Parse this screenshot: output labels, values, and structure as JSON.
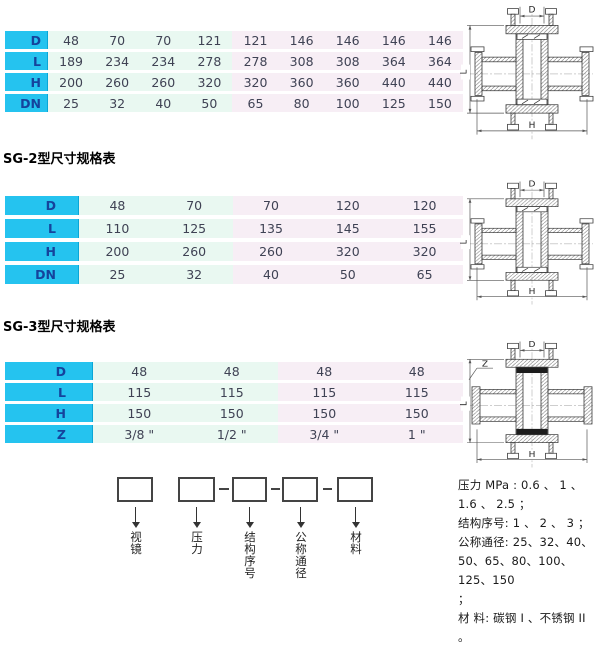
{
  "colors": {
    "header_cyan": "#25c3ef",
    "header_text": "#15439c",
    "mint_bg": "#e9f8f1",
    "pink_bg": "#f7eef5",
    "body_text": "#3f4254"
  },
  "tables": [
    {
      "rows": [
        {
          "label": "D",
          "values": [
            "48",
            "70",
            "70",
            "121",
            "121",
            "146",
            "146",
            "146",
            "146"
          ]
        },
        {
          "label": "L",
          "values": [
            "189",
            "234",
            "234",
            "278",
            "278",
            "308",
            "308",
            "364",
            "364"
          ]
        },
        {
          "label": "H",
          "values": [
            "200",
            "260",
            "260",
            "320",
            "320",
            "360",
            "360",
            "440",
            "440"
          ]
        },
        {
          "label": "DN",
          "values": [
            "25",
            "32",
            "40",
            "50",
            "65",
            "80",
            "100",
            "125",
            "150"
          ]
        }
      ],
      "mint_columns": 4
    },
    {
      "title": "SG-2型尺寸规格表",
      "rows": [
        {
          "label": "D",
          "values": [
            "48",
            "70",
            "70",
            "120",
            "120"
          ]
        },
        {
          "label": "L",
          "values": [
            "110",
            "125",
            "135",
            "145",
            "155"
          ]
        },
        {
          "label": "H",
          "values": [
            "200",
            "260",
            "260",
            "320",
            "320"
          ]
        },
        {
          "label": "DN",
          "values": [
            "25",
            "32",
            "40",
            "50",
            "65"
          ]
        }
      ],
      "mint_columns": 2
    },
    {
      "title": "SG-3型尺寸规格表",
      "rows": [
        {
          "label": "D",
          "values": [
            "48",
            "48",
            "48",
            "48"
          ]
        },
        {
          "label": "L",
          "values": [
            "115",
            "115",
            "115",
            "115"
          ]
        },
        {
          "label": "H",
          "values": [
            "150",
            "150",
            "150",
            "150"
          ]
        },
        {
          "label": "Z",
          "values": [
            "3/8 \"",
            "1/2 \"",
            "3/4 \"",
            "1 \""
          ]
        }
      ],
      "mint_columns": 2
    }
  ],
  "drawings": [
    {
      "dim_top": "D",
      "dim_left": "L",
      "dim_bottom": "H"
    },
    {
      "dim_top": "D",
      "dim_left": "L",
      "dim_bottom": "H"
    },
    {
      "dim_top": "D",
      "dim_left": "L",
      "dim_bottom": "H",
      "dim_thread": "Z"
    }
  ],
  "designation": {
    "boxes": [
      {
        "label": "视镜"
      },
      {
        "label": "压力"
      },
      {
        "label": "结构序号"
      },
      {
        "label": "公称通径"
      },
      {
        "label": "材料"
      }
    ]
  },
  "notes": {
    "lines": [
      "压力 MPa : 0.6 、 1 、",
      "1.6 、 2.5 ；",
      "结构序号: 1 、 2 、 3 ；",
      "公称通径: 25、32、40、",
      "50、65、80、100、125、150",
      "；",
      "材 料: 碳钢 I 、不锈钢 II",
      "。"
    ]
  }
}
